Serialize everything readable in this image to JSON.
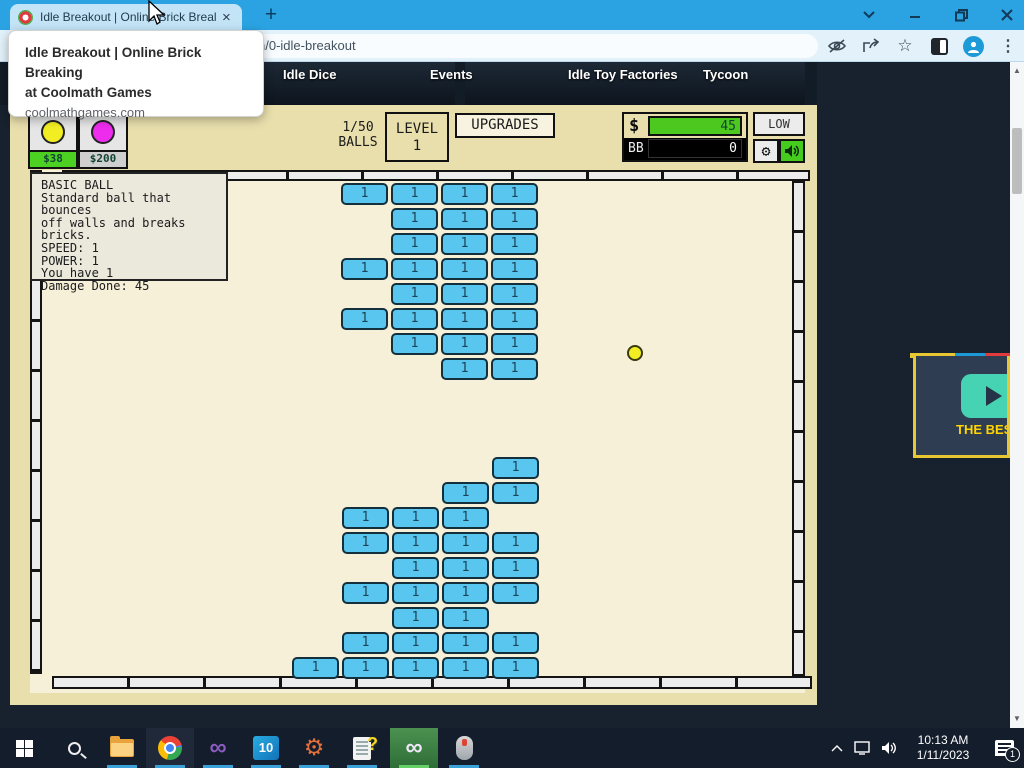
{
  "browser": {
    "tab_title": "Idle Breakout | Online Brick Breal",
    "tab_close": "×",
    "new_tab": "+",
    "url": "n/0-idle-breakout",
    "tooltip": {
      "title_line1": "Idle Breakout | Online Brick Breaking",
      "title_line2": "at Coolmath Games",
      "domain": "coolmathgames.com"
    },
    "icons": {
      "star": "☆",
      "dots": "⋮"
    }
  },
  "site_nav": {
    "items": [
      "Idle Dice",
      "Events",
      "Idle Toy Factories",
      "Tycoon"
    ]
  },
  "game": {
    "shop": [
      {
        "name": "basic-ball",
        "ball_color": "#f2ee24",
        "price": "$38",
        "price_bg": "#4cd122"
      },
      {
        "name": "plasma-ball",
        "ball_color": "#ee2cee",
        "price": "$200",
        "price_bg": "#cfcfcf"
      }
    ],
    "ball_counter": {
      "count": "1/50",
      "label": "BALLS"
    },
    "level": {
      "label": "LEVEL",
      "value": "1"
    },
    "upgrades_label": "UPGRADES",
    "money": {
      "symbol": "$",
      "value": "45",
      "bb_label": "BB",
      "bb_value": "0"
    },
    "quality_label": "LOW",
    "settings_gear": "⚙",
    "info_box": {
      "lines": [
        "BASIC BALL",
        "Standard ball that bounces",
        "off walls and breaks bricks.",
        "SPEED: 1",
        "POWER: 1",
        "You have 1",
        "Damage Done: 45"
      ]
    },
    "brick_value": "1",
    "brick_color": "#58c6ee",
    "bricks": [
      [
        341,
        183
      ],
      [
        391,
        183
      ],
      [
        441,
        183
      ],
      [
        491,
        183
      ],
      [
        391,
        208
      ],
      [
        441,
        208
      ],
      [
        491,
        208
      ],
      [
        391,
        233
      ],
      [
        441,
        233
      ],
      [
        491,
        233
      ],
      [
        341,
        258
      ],
      [
        391,
        258
      ],
      [
        441,
        258
      ],
      [
        491,
        258
      ],
      [
        391,
        283
      ],
      [
        441,
        283
      ],
      [
        491,
        283
      ],
      [
        341,
        308
      ],
      [
        391,
        308
      ],
      [
        441,
        308
      ],
      [
        491,
        308
      ],
      [
        391,
        333
      ],
      [
        441,
        333
      ],
      [
        491,
        333
      ],
      [
        441,
        358
      ],
      [
        491,
        358
      ],
      [
        492,
        457
      ],
      [
        442,
        482
      ],
      [
        492,
        482
      ],
      [
        342,
        507
      ],
      [
        392,
        507
      ],
      [
        442,
        507
      ],
      [
        342,
        532
      ],
      [
        392,
        532
      ],
      [
        442,
        532
      ],
      [
        492,
        532
      ],
      [
        392,
        557
      ],
      [
        442,
        557
      ],
      [
        492,
        557
      ],
      [
        342,
        582
      ],
      [
        392,
        582
      ],
      [
        442,
        582
      ],
      [
        492,
        582
      ],
      [
        392,
        607
      ],
      [
        442,
        607
      ],
      [
        342,
        632
      ],
      [
        392,
        632
      ],
      [
        442,
        632
      ],
      [
        492,
        632
      ],
      [
        292,
        657
      ],
      [
        342,
        657
      ],
      [
        392,
        657
      ],
      [
        442,
        657
      ],
      [
        492,
        657
      ]
    ],
    "ball": {
      "x": 627,
      "y": 345,
      "color": "#f2ee24"
    }
  },
  "ad": {
    "text": "THE BES"
  },
  "taskbar": {
    "win10_label": "10",
    "vs_infinity": "∞",
    "time": "10:13 AM",
    "date": "1/11/2023",
    "notification_count": "1"
  }
}
